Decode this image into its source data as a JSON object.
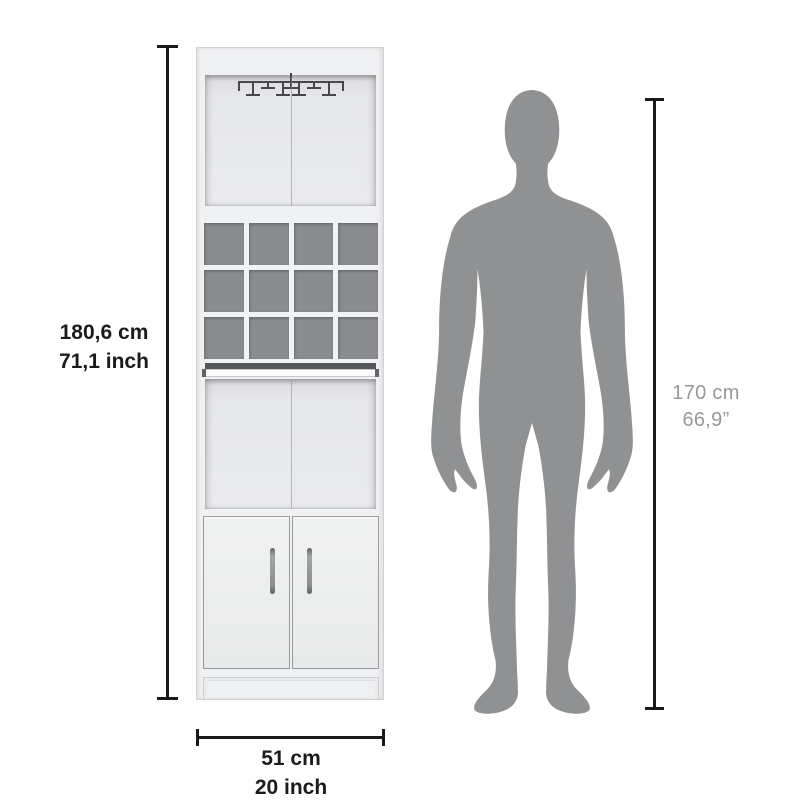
{
  "diagram": {
    "product": {
      "height_cm": "180,6 cm",
      "height_inch": "71,1 inch",
      "width_cm": "51 cm",
      "width_inch": "20 inch"
    },
    "person": {
      "height_cm": "170 cm",
      "height_inch": "66,9”"
    }
  },
  "shapes": {
    "person_silhouette": "standing-man-front-silhouette",
    "stemware_rack": "hanging-stemware-rack",
    "wine_cubbies": "4x3-bottle-grid"
  },
  "colors": {
    "background": "#ffffff",
    "dimension_line": "#1a1a1a",
    "primary_label_text": "#1b1b1b",
    "secondary_label_text": "#96989a",
    "silhouette": "#8f9193",
    "cabinet_body": "#f0f1f2",
    "cubby_back": "#8a8c8e",
    "rack_wire": "#46484a"
  }
}
